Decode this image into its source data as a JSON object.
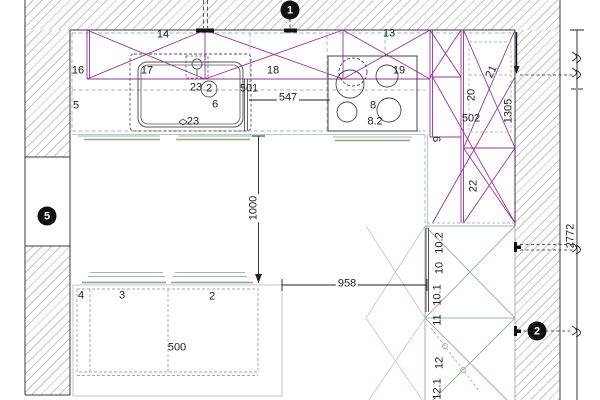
{
  "drawing": {
    "type": "kitchen-floor-plan",
    "labels": {
      "n16": "16",
      "n17": "17",
      "n14": "14",
      "n18": "18",
      "n13": "13",
      "n19": "19",
      "n5": "5",
      "n23a": "23",
      "ncirc2": "2",
      "n501": "501",
      "n6": "6",
      "n23b": "23",
      "n8": "8",
      "n82": "8.2",
      "n20": "20",
      "n21": "21",
      "n502": "502",
      "n9": "9",
      "n22": "22",
      "n4": "4",
      "n3": "3",
      "n2": "2",
      "n102": "10.2",
      "n10": "10",
      "n101": "10.1",
      "n11": "11",
      "n12": "12",
      "n121": "12.1"
    },
    "dimensions": {
      "d547": "547",
      "d1000": "1000",
      "d958": "958",
      "d500": "500",
      "d1305": "1305",
      "d2772": "2772"
    },
    "markers": {
      "m1": "1",
      "m5": "5",
      "m2": "2"
    },
    "colors": {
      "wall_cabinet_magenta": "#993399",
      "countertop_teal": "#93bac6",
      "unit_green": "#9dbb9d",
      "wall_outline": "#3a3a3a",
      "dimension": "#222222",
      "marker_bg": "#111111",
      "hatch": "#c6c6c6"
    }
  }
}
